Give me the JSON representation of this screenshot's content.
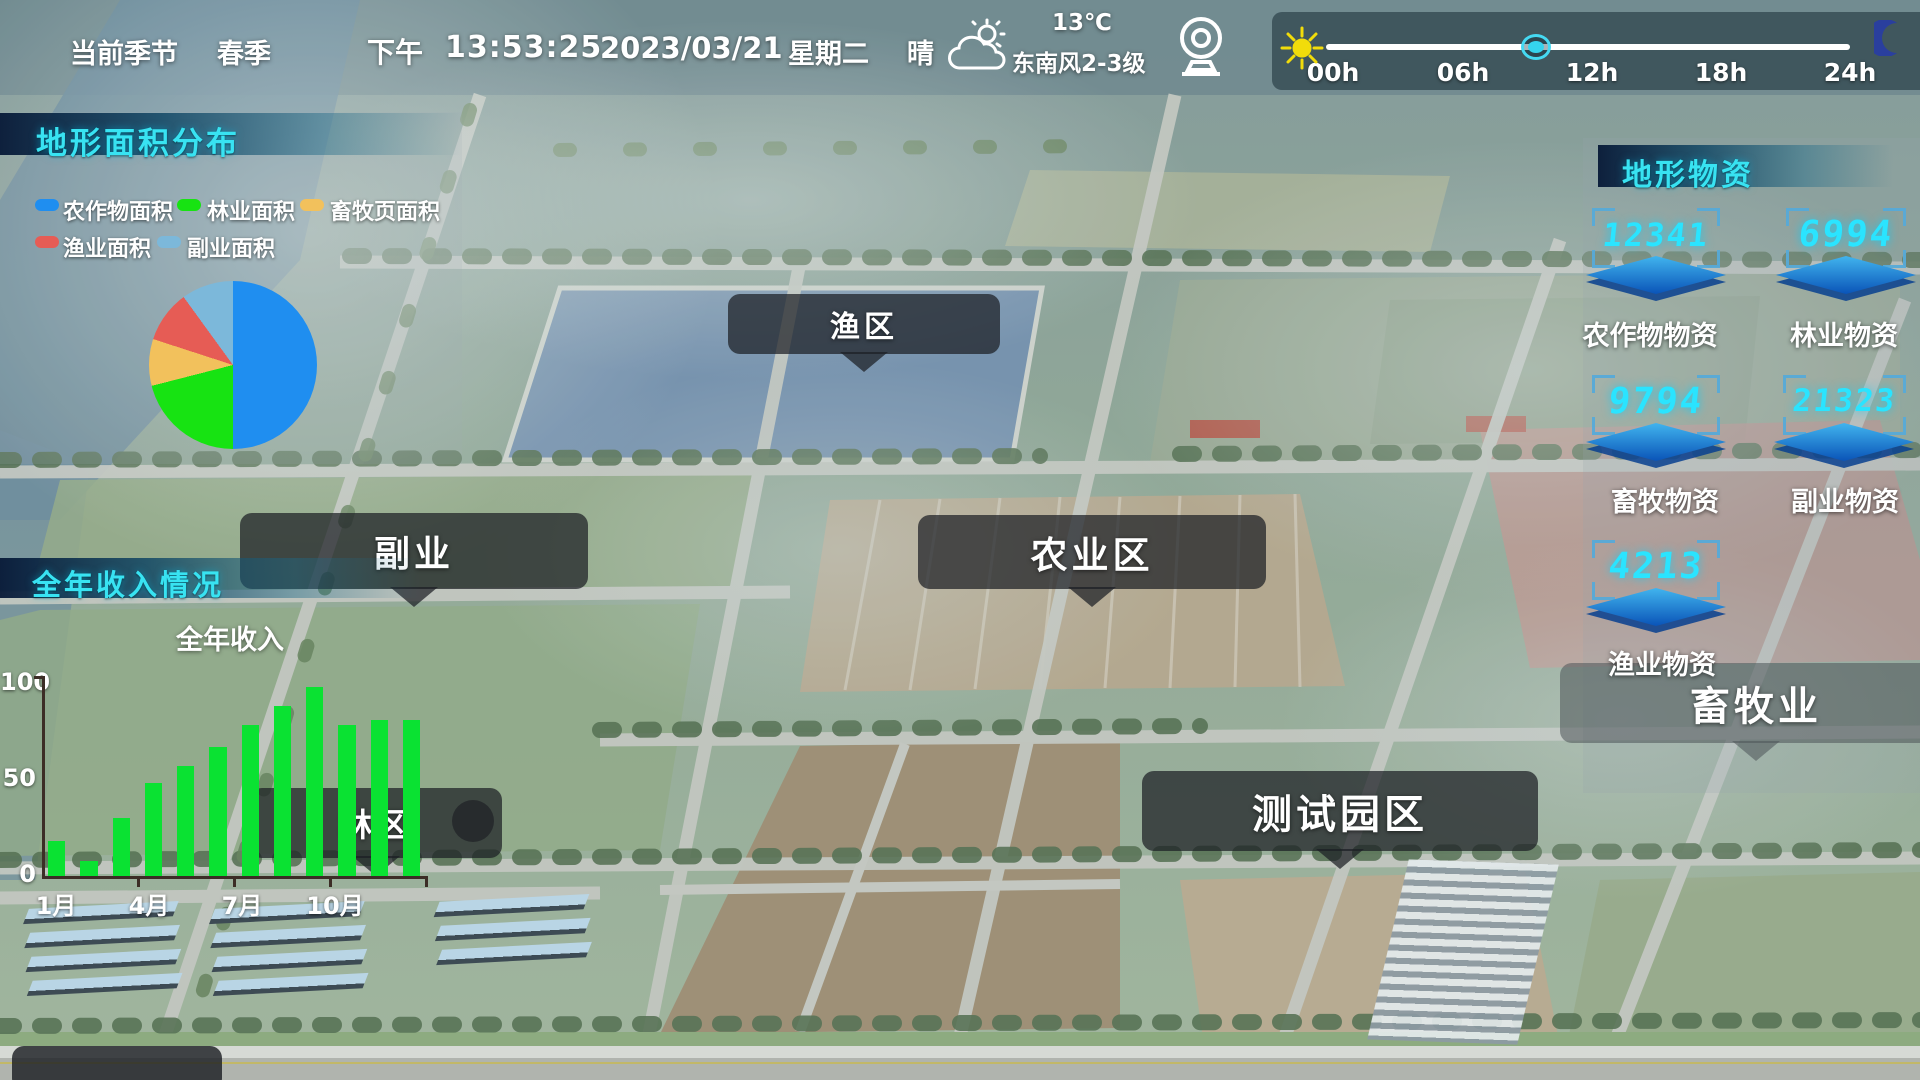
{
  "accent_color": "#38e3f2",
  "top_bar": {
    "season_label": "当前季节",
    "season_value": "春季",
    "period": "下午",
    "time": "13:53:25",
    "date": "2023/03/21",
    "weekday": "星期二",
    "weather": "晴",
    "temperature": "13℃",
    "wind": "东南风2-3级"
  },
  "time_slider": {
    "ticks": [
      "00h",
      "06h",
      "12h",
      "18h",
      "24h"
    ],
    "handle_fraction": 0.4
  },
  "panels": {
    "terrain": {
      "title": "地形面积分布"
    },
    "income": {
      "title": "全年收入情况",
      "series_label": "全年收入"
    },
    "supplies": {
      "title": "地形物资",
      "items": [
        {
          "value": "12341",
          "label": "农作物物资"
        },
        {
          "value": "6994",
          "label": "林业物资"
        },
        {
          "value": "9794",
          "label": "畜牧物资"
        },
        {
          "value": "21323",
          "label": "副业物资"
        },
        {
          "value": "4213",
          "label": "渔业物资"
        }
      ]
    }
  },
  "map_labels": {
    "fish_zone": "渔区",
    "sideline": "副业",
    "agriculture_zone": "农业区",
    "forest_zone": "林区",
    "test_park": "测试园区",
    "husbandry": "畜牧业"
  },
  "chart_data": [
    {
      "type": "pie",
      "title": "地形面积分布",
      "labels": [
        "农作物面积",
        "林业面积",
        "畜牧页面积",
        "渔业面积",
        "副业面积"
      ],
      "values": [
        50,
        21,
        9,
        10,
        10
      ],
      "colors": [
        "#1f8ef0",
        "#17e312",
        "#f2c15c",
        "#e65c55",
        "#7cb8da"
      ],
      "legend_position": "top"
    },
    {
      "type": "bar",
      "title": "全年收入情况",
      "series_label": "全年收入",
      "categories": [
        "1月",
        "2月",
        "3月",
        "4月",
        "5月",
        "6月",
        "7月",
        "8月",
        "9月",
        "10月",
        "11月",
        "12月"
      ],
      "values": [
        18,
        8,
        30,
        48,
        57,
        67,
        78,
        88,
        98,
        78,
        81,
        81
      ],
      "x_tick_labels": [
        "1月",
        "4月",
        "7月",
        "10月"
      ],
      "yticks": [
        0,
        50,
        100
      ],
      "ylim": [
        0,
        100
      ],
      "bar_color": "#0ae232",
      "grid": false
    }
  ]
}
